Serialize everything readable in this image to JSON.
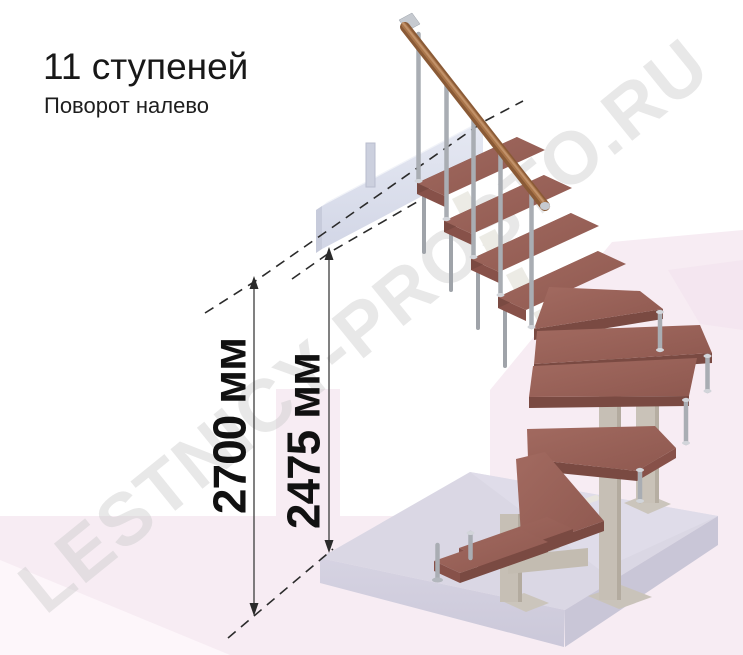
{
  "header": {
    "title": "11 ступеней",
    "subtitle": "Поворот налево"
  },
  "watermark": {
    "text": "LESTNICY-PROSTO.RU"
  },
  "dimensions": [
    {
      "id": "total-height",
      "label": "2700 мм",
      "value": 2700,
      "unit": "мм"
    },
    {
      "id": "landing-height",
      "label": "2475 мм",
      "value": 2475,
      "unit": "мм"
    }
  ],
  "scene": {
    "description": "3D render of a modular staircase turning left: 11 wooden treads (straight upper flight, winder treads around support posts, short lower flight), metal balusters, wooden handrail, upper landing beam and concrete base slab",
    "colors": {
      "tread_wood": "#9a6157",
      "tread_edge": "#7a4a42",
      "handrail_wood": "#8a5a36",
      "metal_baluster": "#a9adb3",
      "support_column": "#c6bfb5",
      "landing_beam": "#dde1ee",
      "floor_slab": "#d9d6e4",
      "background_pink": "#f7ecf3",
      "dimension_ink": "#2b2b2b",
      "watermark_gray": "#c9c9c9"
    }
  }
}
